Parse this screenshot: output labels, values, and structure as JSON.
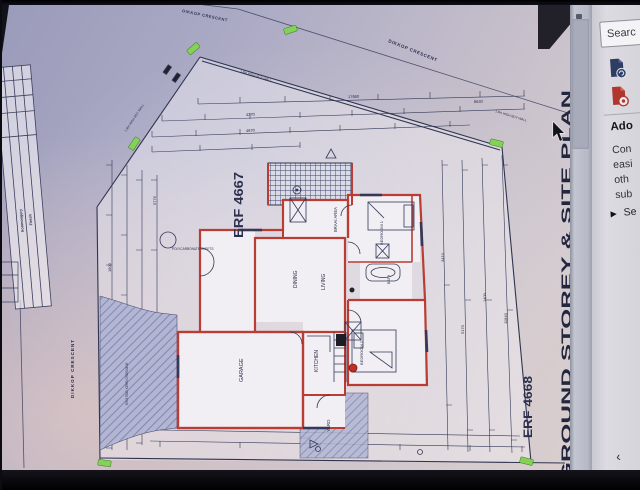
{
  "viewer": {
    "search_label": "Searc",
    "tools": [
      {
        "label": "export-pdf-tool"
      },
      {
        "label": "create-pdf-tool"
      }
    ],
    "panel": {
      "heading": "Ado",
      "lines": [
        "Con",
        "easi",
        "oth",
        "sub"
      ],
      "link": "Se"
    },
    "collapse_chevron": "‹"
  },
  "plan": {
    "title": "GROUND STOREY & SITE PLAN",
    "erf_main": "ERF 4667",
    "erf_adjacent": "ERF 4668",
    "street_top": "DIKKOP CRESCENT",
    "street_left": "DIKKOP CRESCENT",
    "street_top_edge": "DIKKOP CRESCENT",
    "rooms": {
      "garage": "GARAGE",
      "kitchen": "KITCHEN",
      "living": "LIVING",
      "dining": "DINING",
      "braai": "BRAAI AREA",
      "bedroom1": "BEDROOM 1",
      "bedroom2": "BEDROOM 2",
      "bath": "BATH",
      "yard": "YARD"
    },
    "notes": {
      "boundary_wall": "1.8m HIGH BDY WALL",
      "polycarb": "POLYCARBONATE SHEETS",
      "kerb": "EXISTING KERB CROSSING"
    },
    "dimensions": [
      "17660",
      "8640",
      "4670",
      "4270",
      "3400",
      "2600",
      "1800",
      "5170",
      "3410",
      "1400",
      "11840",
      "13410",
      "5776"
    ],
    "titleblock": {
      "rows": [
        "Ironmongery",
        "Finish"
      ]
    },
    "colors": {
      "wall": "#c23b31",
      "marker": "#7ed34f",
      "line": "#33395c"
    }
  }
}
